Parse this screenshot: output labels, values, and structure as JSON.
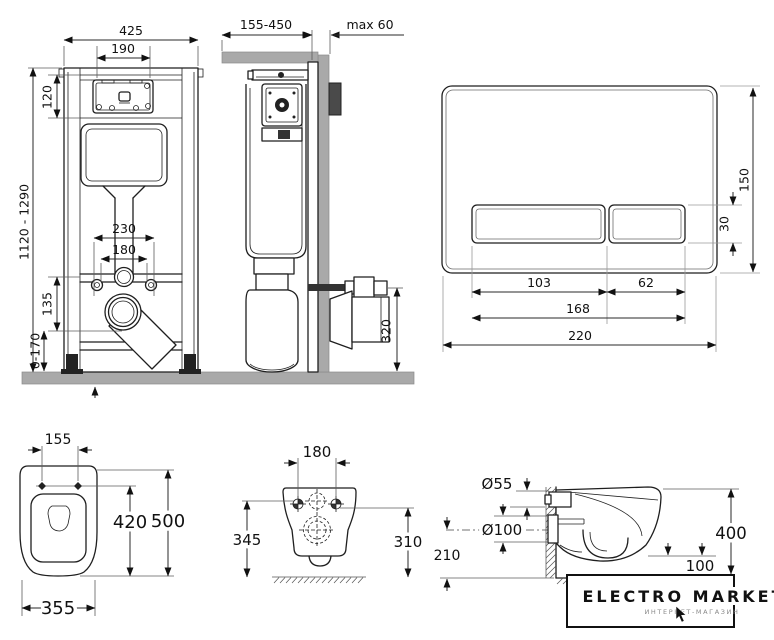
{
  "colors": {
    "line": "#1f1f1f",
    "dimension": "#2a2a2a",
    "fill_gray": "#a9a9a9",
    "bracket_gray": "#4a4a4a",
    "logo_text": "#111111",
    "logo_subtext": "#8a8a8a",
    "background": "#ffffff"
  },
  "views": {
    "frame_front": {
      "dims": {
        "frame_width": "425",
        "mech_width": "190",
        "panel_height": "120",
        "frame_height_range": "1120 - 1290",
        "fixing_spacing_outer": "230",
        "fixing_spacing_inner": "180",
        "outlet_offset": "135",
        "foot_adjust_range": "0-170"
      }
    },
    "frame_side": {
      "dims": {
        "depth_range": "155-450",
        "max_panel": "max 60",
        "outlet_height": "320"
      }
    },
    "flush_plate": {
      "dims": {
        "plate_height": "150",
        "button_height": "30",
        "large_button_width": "103",
        "small_button_width": "62",
        "buttons_total_width": "168",
        "plate_width": "220"
      }
    },
    "pan_top": {
      "dims": {
        "hole_spacing": "155",
        "hole_to_front": "420",
        "total_length": "500",
        "bowl_width": "355"
      }
    },
    "pan_back": {
      "dims": {
        "fixing_spacing": "180",
        "left_height": "345",
        "right_height": "310"
      }
    },
    "pan_side": {
      "dims": {
        "inlet_diameter": "Ø55",
        "outlet_diameter": "Ø100",
        "outlet_center_height": "210",
        "installed_height": "400",
        "bottom_clearance": "100"
      }
    }
  },
  "logo": {
    "title": "ELECTRO MARKET",
    "subtitle": "ИНТЕРНЕТ-МАГАЗИН"
  }
}
